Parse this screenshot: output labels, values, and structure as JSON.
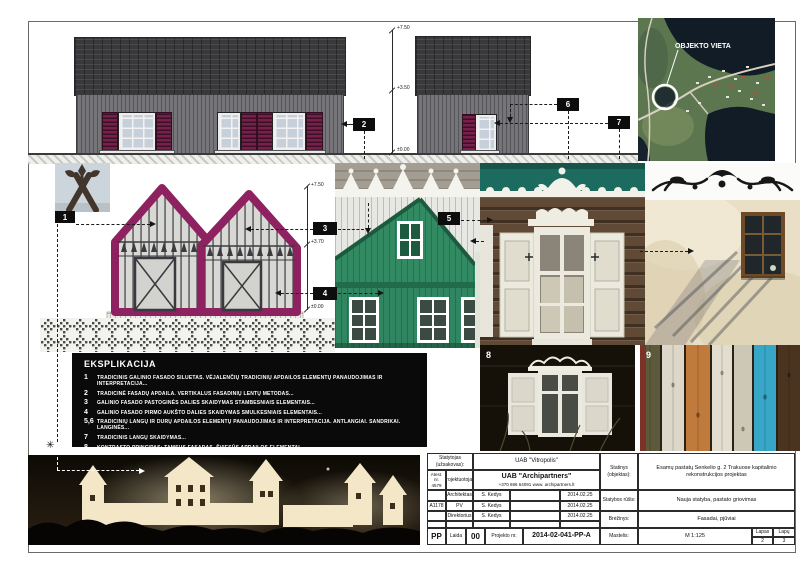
{
  "map": {
    "label": "OBJEKTO VIETA"
  },
  "markers": {
    "m1": "1",
    "m2": "2",
    "m3": "3",
    "m4": "4",
    "m5": "5",
    "m6": "6",
    "m7": "7"
  },
  "photos": {
    "p8_label": "8",
    "p9_label": "9"
  },
  "levels": {
    "elev2": {
      "top": "+7.50",
      "mid": "+3.50",
      "zero": "±0.00"
    },
    "concept": {
      "top": "+7.50",
      "mid": "+3.70",
      "zero": "±0.00"
    }
  },
  "legend": {
    "title": "EKSPLIKACIJA",
    "items": [
      {
        "num": "1",
        "text": "TRADICINIS GALINIO FASADO SILUETAS. VĖJALENČIŲ TRADICINIŲ APDAILOS ELEMENTŲ PANAUDOJIMAS IR INTERPRETACIJA..."
      },
      {
        "num": "2",
        "text": "TRADICINĖ FASADŲ APDAILA. VERTIKALUS FASADINIŲ LENTŲ METODAS..."
      },
      {
        "num": "3",
        "text": "GALINIO FASADO PASTOGINĖS DALIES SKAIDYMAS STAMBESNIAIS ELEMENTAIS..."
      },
      {
        "num": "4",
        "text": "GALINIO FASADO PIRMO AUKŠTO DALIES SKAIDYMAS SMULKESNIAIS ELEMENTAIS..."
      },
      {
        "num": "5,6",
        "text": "TRADICINIŲ LANGŲ IR DURŲ APDAILOS ELEMENTŲ PANAUDOJIMAS IR INTERPRETACIJA. ANTLANGIAI. SANDRIKAI. LANGINĖS..."
      },
      {
        "num": "7",
        "text": "TRADICINIS LANGŲ SKAIDYMAS..."
      },
      {
        "num": "8",
        "text": "KONTRASTO PRINCIPAS: TAMSUS FASADAS, ŠVIESŪS APDAILOS ELEMENTAI..."
      },
      {
        "num": "9",
        "text": "TRADICINĖS MEDŽIAGOS..."
      }
    ]
  },
  "titleblock": {
    "statytojas_label": "Statytojas (užsakovas):",
    "statytojas_value": "UAB \"Vitropolis\"",
    "atest_label": "Atest. nr.",
    "atest_value": "4579",
    "projektuotojas_label": "Projektuotojas:",
    "projektuotojas_name": "UAB \"Archipartners\"",
    "projektuotojas_contacts": "+370 686 64091 www. archipartners.lt",
    "roles": [
      {
        "cert": "",
        "role": "Architektas",
        "name": "S. Kedys",
        "date": "2014.02.25"
      },
      {
        "cert": "A1178",
        "role": "PV",
        "name": "S. Kedys",
        "date": "2014.02.25"
      },
      {
        "cert": "",
        "role": "Direktorius",
        "name": "S. Kedys",
        "date": "2014.02.25"
      }
    ],
    "stage": "PP",
    "laida_label": "Laida",
    "laida_value": "00",
    "projekto_nr_label": "Projekto nr.",
    "projekto_nr_value": "2014-02-041-PP-A",
    "statinys_label": "Statinys (objektas):",
    "statinys_value": "Esamų pastatų Senkelio g. 2 Trakuose kapitalinio rekonstrukcijos projektas",
    "statybos_label": "Statybos rūšis:",
    "statybos_value": "Nauja statyba, pastato griovimas",
    "brezinys_label": "Brėžinys:",
    "brezinys_value": "Fasadai, pjūviai",
    "mastelis_label": "Mastelis:",
    "mastelis_value": "M 1:125",
    "lapas_label": "Lapas",
    "lapas_value": "2",
    "lapu_label": "Lapų",
    "lapu_value": "3"
  },
  "colors": {
    "accent_magenta": "#8e2160",
    "shutter_maroon": "#77204b",
    "roof_dark": "#39393c",
    "wall_gray": "#75757a",
    "legend_bg": "#0a0a0a",
    "map_water": "#121c26",
    "green_house": "#2f8660",
    "teal_strip": "#1d6b5e",
    "blue_plank": "#38a6c6"
  }
}
